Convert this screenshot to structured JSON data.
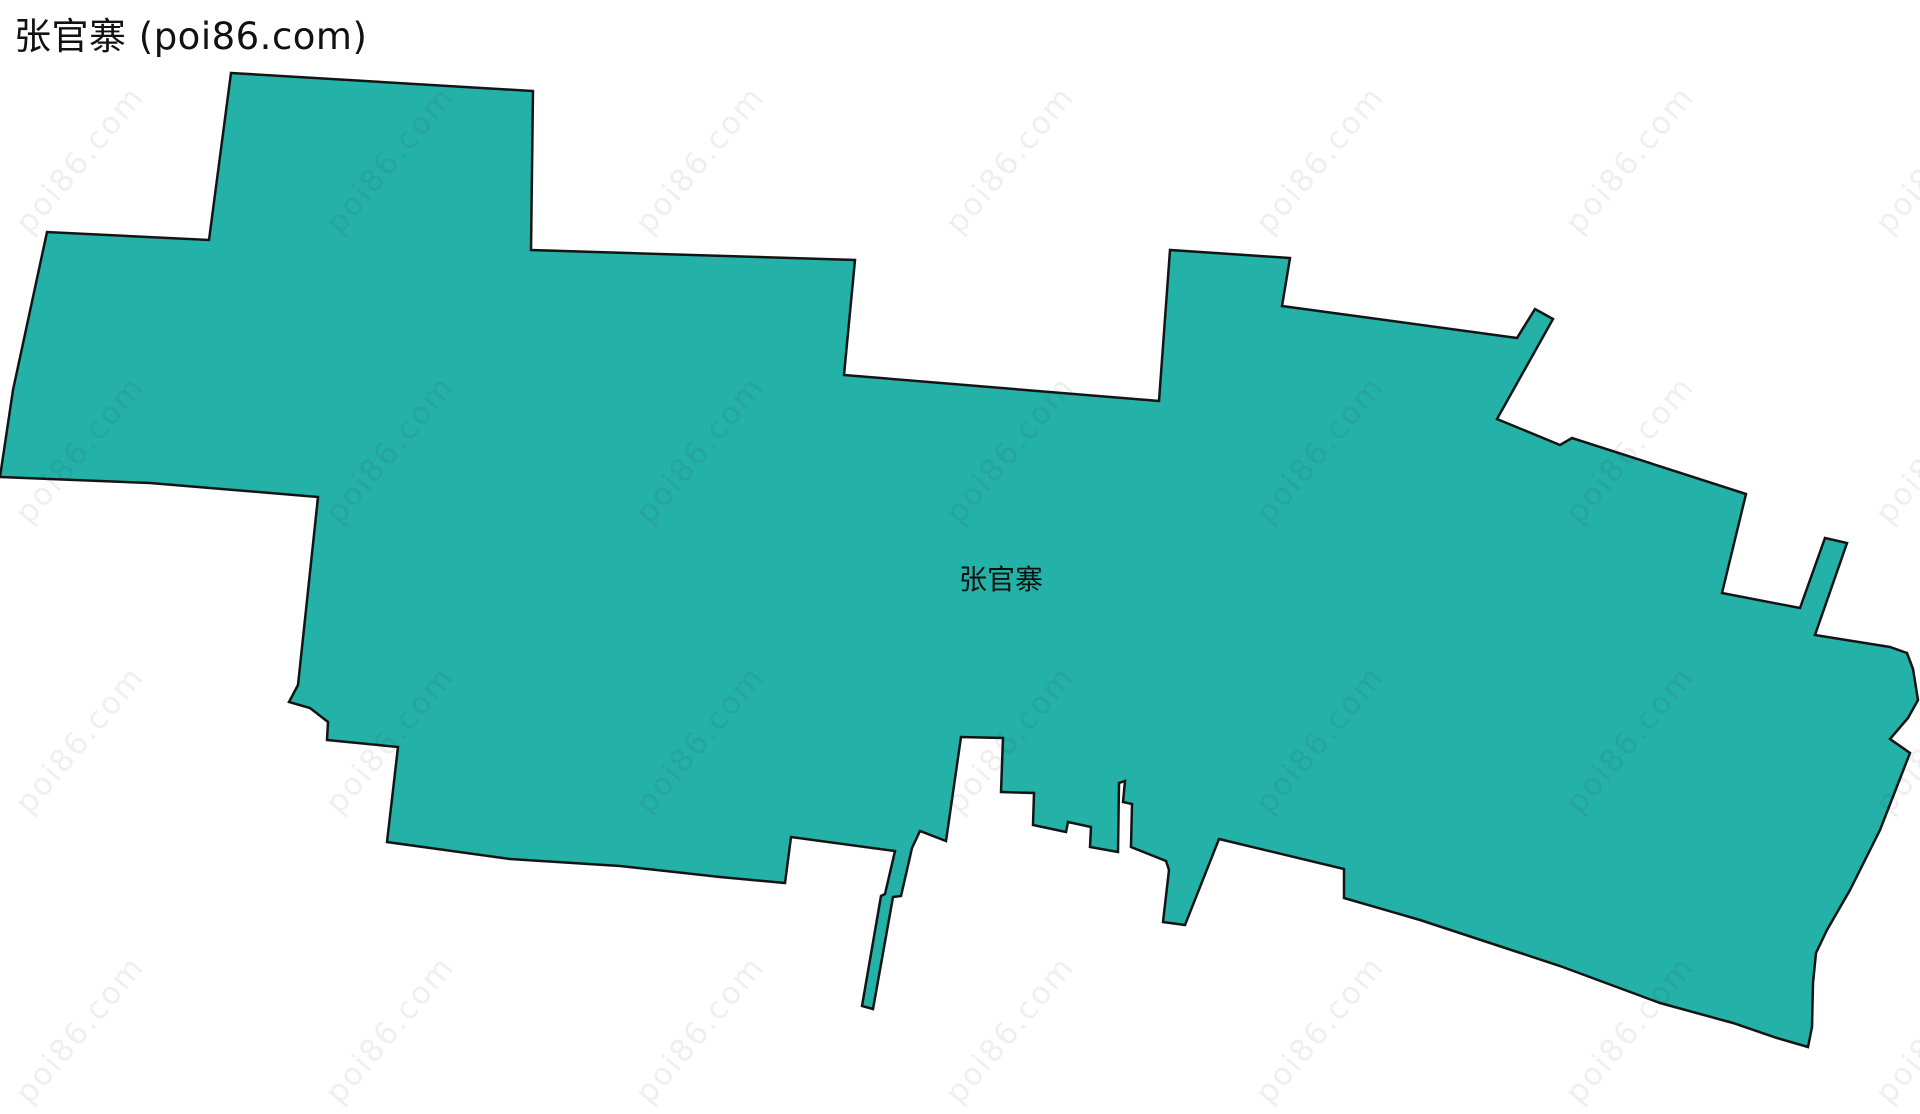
{
  "page": {
    "width": 1920,
    "height": 1114,
    "background_color": "#ffffff"
  },
  "header": {
    "title": "张官寨 (poi86.com)"
  },
  "map": {
    "region_label": "张官寨",
    "label_position": {
      "x": 1001,
      "y": 578
    },
    "fill_color": "#24b1a8",
    "stroke_color": "#141414",
    "stroke_width": 2.5,
    "polygon_points": [
      [
        231,
        73
      ],
      [
        533,
        91
      ],
      [
        531,
        250
      ],
      [
        855,
        260
      ],
      [
        844,
        375
      ],
      [
        1159,
        401
      ],
      [
        1170,
        250
      ],
      [
        1290,
        258
      ],
      [
        1282,
        306
      ],
      [
        1517,
        338
      ],
      [
        1535,
        309
      ],
      [
        1553,
        319
      ],
      [
        1497,
        419
      ],
      [
        1560,
        445
      ],
      [
        1572,
        438
      ],
      [
        1746,
        494
      ],
      [
        1722,
        593
      ],
      [
        1800,
        608
      ],
      [
        1825,
        538
      ],
      [
        1847,
        543
      ],
      [
        1815,
        635
      ],
      [
        1890,
        647
      ],
      [
        1907,
        653
      ],
      [
        1913,
        669
      ],
      [
        1918,
        700
      ],
      [
        1908,
        718
      ],
      [
        1890,
        739
      ],
      [
        1910,
        753
      ],
      [
        1880,
        830
      ],
      [
        1850,
        890
      ],
      [
        1827,
        930
      ],
      [
        1816,
        953
      ],
      [
        1813,
        983
      ],
      [
        1812,
        1027
      ],
      [
        1808,
        1047
      ],
      [
        1777,
        1038
      ],
      [
        1733,
        1023
      ],
      [
        1660,
        1003
      ],
      [
        1560,
        966
      ],
      [
        1420,
        920
      ],
      [
        1344,
        898
      ],
      [
        1344,
        869
      ],
      [
        1219,
        839
      ],
      [
        1185,
        925
      ],
      [
        1163,
        922
      ],
      [
        1169,
        870
      ],
      [
        1166,
        861
      ],
      [
        1131,
        847
      ],
      [
        1132,
        804
      ],
      [
        1123,
        802
      ],
      [
        1125,
        781
      ],
      [
        1119,
        783
      ],
      [
        1118,
        852
      ],
      [
        1090,
        847
      ],
      [
        1091,
        827
      ],
      [
        1068,
        822
      ],
      [
        1066,
        832
      ],
      [
        1033,
        825
      ],
      [
        1034,
        793
      ],
      [
        1001,
        792
      ],
      [
        1003,
        738
      ],
      [
        961,
        737
      ],
      [
        946,
        841
      ],
      [
        920,
        831
      ],
      [
        912,
        848
      ],
      [
        901,
        896
      ],
      [
        893,
        897
      ],
      [
        873,
        1009
      ],
      [
        862,
        1006
      ],
      [
        881,
        896
      ],
      [
        885,
        894
      ],
      [
        895,
        851
      ],
      [
        791,
        837
      ],
      [
        785,
        883
      ],
      [
        720,
        877
      ],
      [
        620,
        866
      ],
      [
        510,
        859
      ],
      [
        387,
        842
      ],
      [
        398,
        747
      ],
      [
        327,
        740
      ],
      [
        328,
        722
      ],
      [
        310,
        708
      ],
      [
        289,
        702
      ],
      [
        298,
        685
      ],
      [
        318,
        497
      ],
      [
        150,
        483
      ],
      [
        0,
        477
      ],
      [
        13,
        390
      ],
      [
        47,
        232
      ],
      [
        209,
        240
      ]
    ]
  },
  "watermark": {
    "text": "poi86.com",
    "color": "rgba(60,30,30,0.075)",
    "rotation_deg": -50,
    "grid": {
      "col_positions": [
        80,
        390,
        700,
        1010,
        1320,
        1630,
        1940
      ],
      "row_positions": [
        160,
        450,
        740,
        1030
      ]
    }
  }
}
